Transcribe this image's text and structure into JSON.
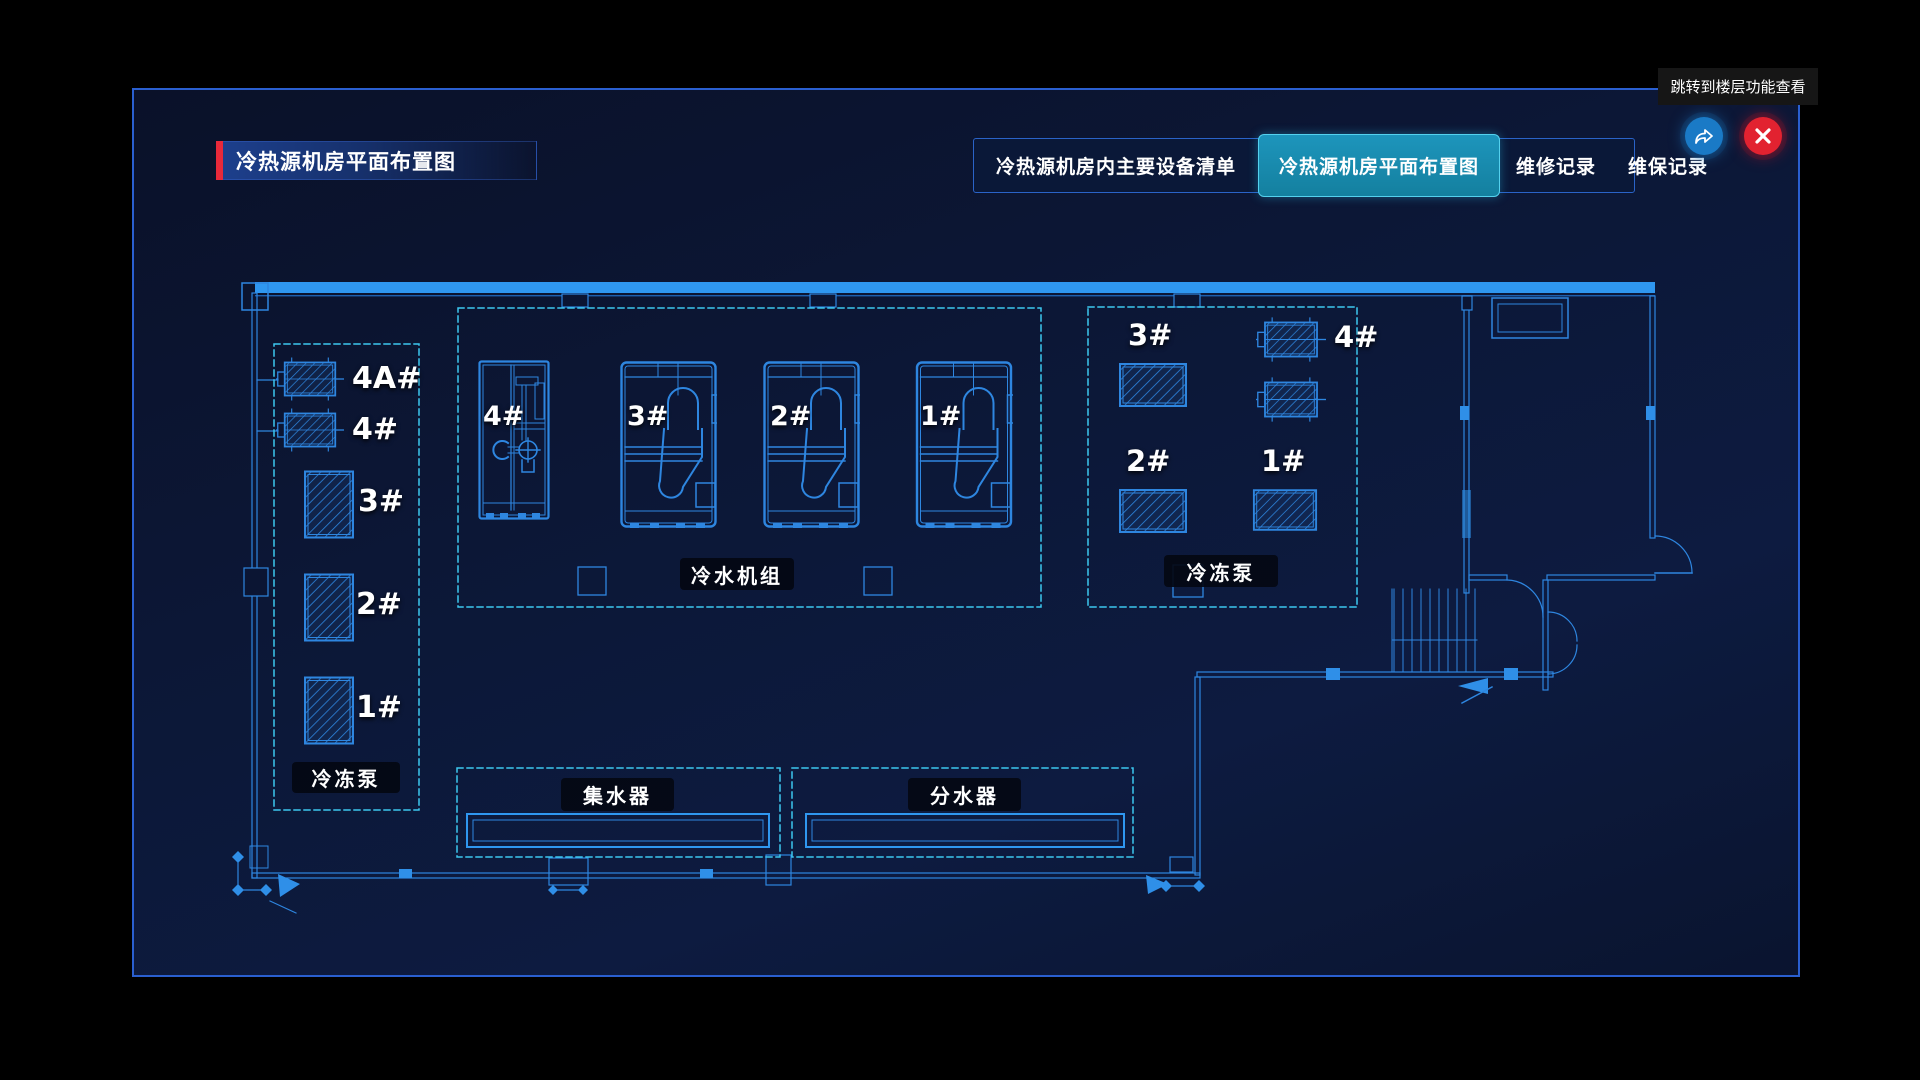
{
  "header": {
    "title": "冷热源机房平面布置图"
  },
  "tabs": [
    {
      "label": "冷热源机房内主要设备清单",
      "active": false
    },
    {
      "label": "冷热源机房平面布置图",
      "active": true
    },
    {
      "label": "维修记录",
      "active": false
    },
    {
      "label": "维保记录",
      "active": false
    }
  ],
  "tooltip": {
    "text": "跳转到楼层功能查看"
  },
  "actions": {
    "jump_icon": "share-forward-arrow",
    "close_icon": "close-x"
  },
  "floorplan": {
    "left_pump_group": {
      "name": "冷冻泵",
      "units": [
        "4A#",
        "4#",
        "3#",
        "2#",
        "1#"
      ]
    },
    "chiller_group": {
      "name": "冷水机组",
      "units": [
        "4#",
        "3#",
        "2#",
        "1#"
      ]
    },
    "right_pump_group": {
      "name": "冷冻泵",
      "units": [
        "3#",
        "4#",
        "2#",
        "1#"
      ]
    },
    "collector": {
      "name": "集水器"
    },
    "distributor": {
      "name": "分水器"
    }
  },
  "colors": {
    "accent_red": "#e8293a",
    "panel_border": "#2a5fd0",
    "line_blue": "#2e86e0",
    "wall_blue": "#2f97f0",
    "dash_cyan": "#3dc8ef",
    "tab_active_bg": "#1689ae",
    "tab_active_border": "#54d1ee",
    "jump_button_blue": "#1a7ac6",
    "close_button_red": "#e22230"
  }
}
